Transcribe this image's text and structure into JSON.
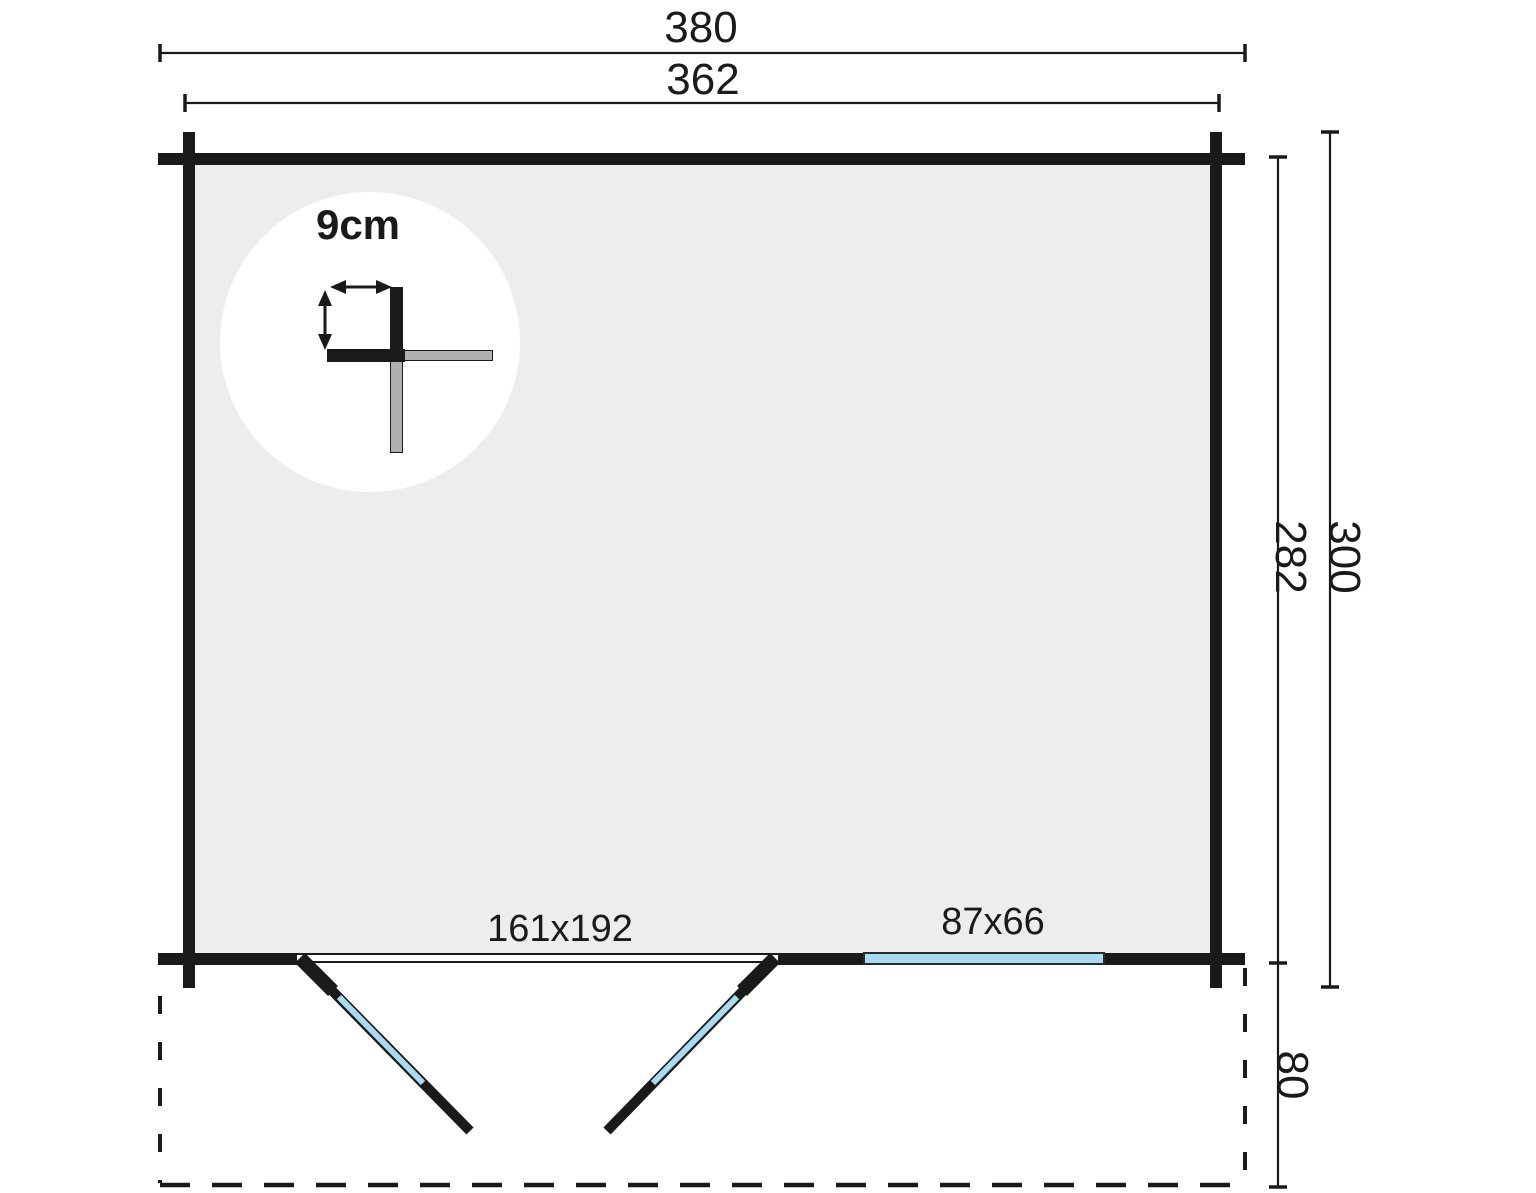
{
  "dimensions": {
    "outer_width": "380",
    "inner_width": "362",
    "outer_depth": "300",
    "inner_depth": "282",
    "terrace_depth": "80"
  },
  "openings": {
    "double_door_label": "161x192",
    "window_label": "87x66"
  },
  "wall_detail": {
    "thickness_label": "9cm"
  },
  "colors": {
    "wall": "#1a1a1a",
    "interior": "#ededed",
    "glass": "#a9daf2",
    "detail-gray": "#b0b0b0",
    "background": "#ffffff"
  }
}
